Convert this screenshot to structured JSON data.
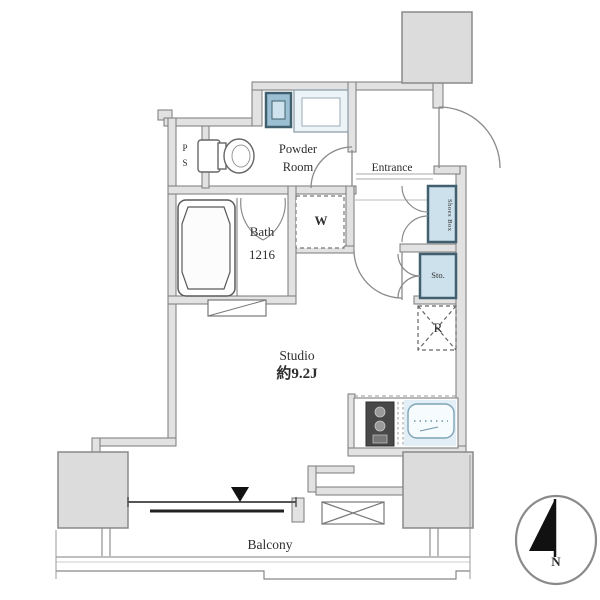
{
  "rooms": {
    "powder_room": {
      "label": "Powder\nRoom"
    },
    "entrance": {
      "label": "Entrance"
    },
    "pipe_space": {
      "label": "P\nS"
    },
    "bath": {
      "label": "Bath\n1216"
    },
    "washer": {
      "label": "W"
    },
    "shoes_box": {
      "label": "Shoes Box"
    },
    "storage": {
      "label": "Sto."
    },
    "refrigerator": {
      "label": "R"
    },
    "studio": {
      "label": "Studio",
      "size": "約9.2J"
    },
    "balcony": {
      "label": "Balcony"
    }
  },
  "compass": {
    "north_label": "N"
  },
  "colors": {
    "wall_fill": "#e2e2e2",
    "wall_line": "#7a7a7a",
    "pillar_fill": "#dcdcdc",
    "fixture_blue_fill": "#cde1ec",
    "fixture_blue_border": "#40606f",
    "sink_fill": "#e2eff6",
    "stove_fill": "#484848",
    "door_arc_line": "#8a8a8a",
    "text": "#2e2e2e"
  }
}
